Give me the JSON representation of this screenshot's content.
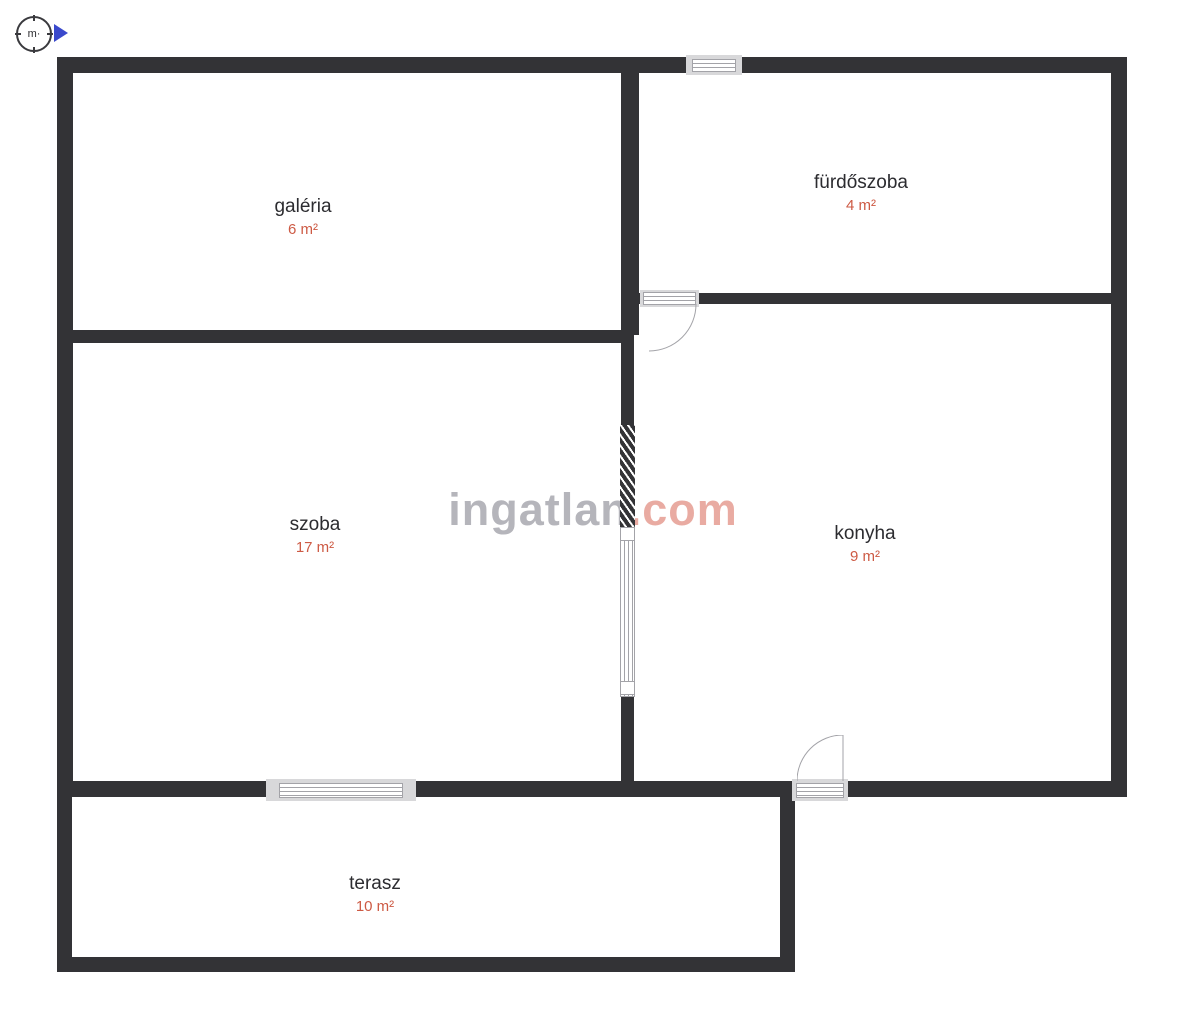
{
  "compass": {
    "label": "m·"
  },
  "watermark": {
    "brand": "ingatlan",
    "tld": ".com"
  },
  "rooms": [
    {
      "id": "galeria",
      "label": "galéria",
      "area": "6 m²"
    },
    {
      "id": "furdoszoba",
      "label": "fürdőszoba",
      "area": "4 m²"
    },
    {
      "id": "szoba",
      "label": "szoba",
      "area": "17 m²"
    },
    {
      "id": "konyha",
      "label": "konyha",
      "area": "9 m²"
    },
    {
      "id": "terasz",
      "label": "terasz",
      "area": "10 m²"
    }
  ],
  "colors": {
    "wall": "#333336",
    "room_label": "#2c2c30",
    "area_text": "#cd5a44",
    "watermark_brand": "#b5b5bb",
    "watermark_tld": "#e9aba2",
    "symbol_line": "#a3a3a8",
    "compass_arrow": "#3a49cc"
  }
}
